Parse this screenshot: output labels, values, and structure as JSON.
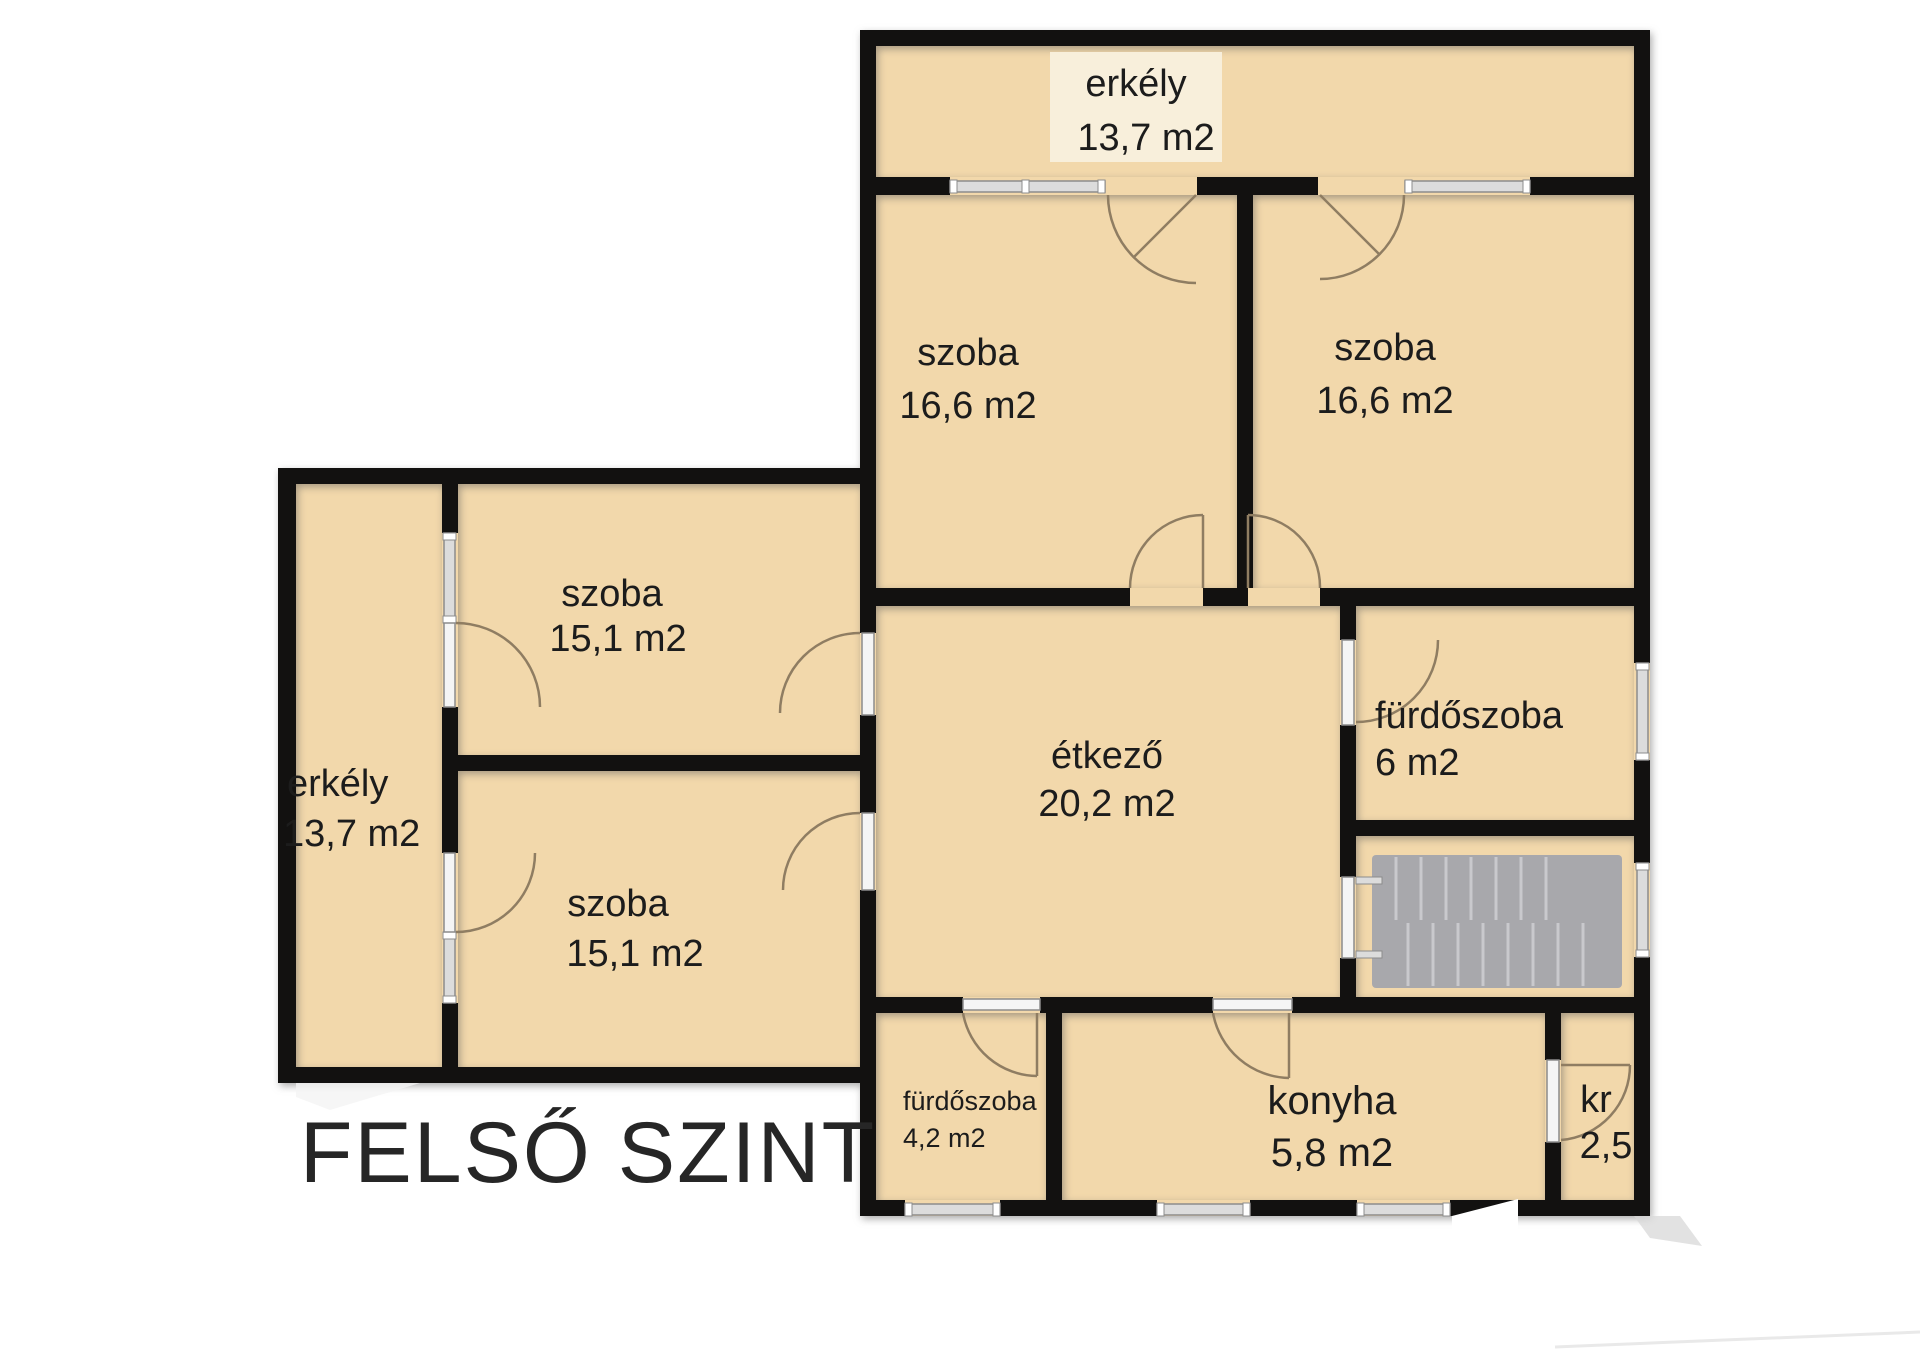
{
  "title": "FELSŐ SZINT",
  "colors": {
    "wall": "#121110",
    "room": "#f2d8ab",
    "window": "#dcdcdc",
    "window_frame": "#8c8c8c",
    "door": "#8f7d62",
    "stairs": "#a8a8ac",
    "stairs_tread": "#c9c9cd",
    "text": "#1c1c1c",
    "label_box": "#f8efdb",
    "shadow": "#d8d8d8"
  },
  "rooms": {
    "balcony_top": {
      "name": "erkély",
      "area": "13,7 m2"
    },
    "room_top_left": {
      "name": "szoba",
      "area": "16,6 m2"
    },
    "room_top_right": {
      "name": "szoba",
      "area": "16,6 m2"
    },
    "room_left_upper": {
      "name": "szoba",
      "area": "15,1 m2"
    },
    "room_left_lower": {
      "name": "szoba",
      "area": "15,1 m2"
    },
    "balcony_left": {
      "name": "erkély",
      "area": "13,7 m2"
    },
    "dining": {
      "name": "étkező",
      "area": "20,2 m2"
    },
    "bathroom_large": {
      "name": "fürdőszoba",
      "area": "6 m2"
    },
    "bathroom_small": {
      "name": "fürdőszoba",
      "area": "4,2 m2"
    },
    "kitchen": {
      "name": "konyha",
      "area": "5,8 m2"
    },
    "pantry": {
      "name": "kr",
      "area": "2,5"
    }
  }
}
